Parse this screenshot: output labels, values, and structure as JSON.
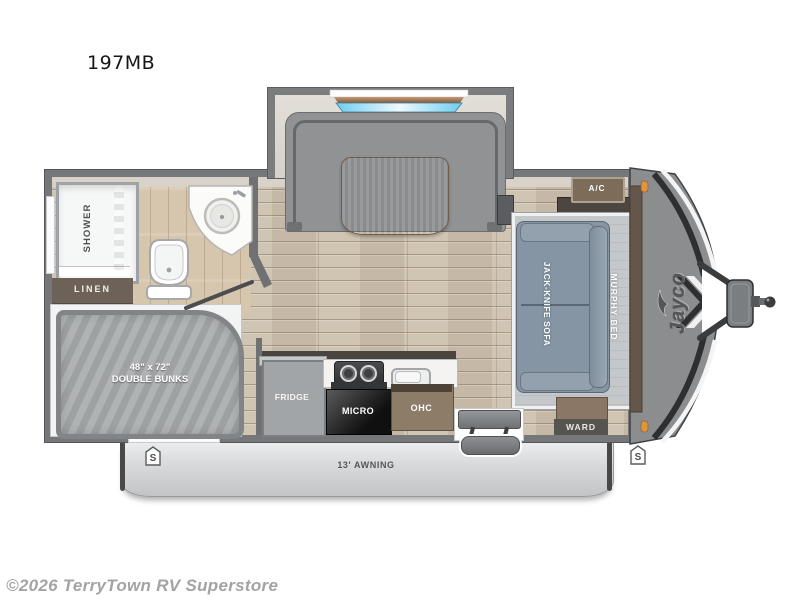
{
  "page": {
    "model_title": "197MB",
    "watermark": "©2026 TerryTown RV Superstore"
  },
  "floorplan": {
    "bathroom": {
      "shower": "SHOWER",
      "linen": "LINEN"
    },
    "bunkroom": {
      "bunks_size": "48\" x 72\"",
      "bunks": "DOUBLE BUNKS"
    },
    "kitchen": {
      "fridge": "FRIDGE",
      "micro": "MICRO",
      "ohc": "OHC"
    },
    "living": {
      "sofa": "JACK-KNIFE SOFA",
      "murphy_bed": "MURPHY BED",
      "ac": "A/C",
      "wardrobe": "WARD"
    },
    "exterior": {
      "awning": "13' AWNING",
      "brand": "Jayco",
      "speaker_badge": "S"
    },
    "colors": {
      "wall_gray": "#75777a",
      "floor_wood": "#cdc0ae",
      "bath_tile": "#d6c6ae",
      "sofa_blue": "#8695a4",
      "mattress_gray": "#a7aaac",
      "marker_orange": "#e0943b",
      "window_glass": "#7fd2ee",
      "curtain_gold": "#d9a855"
    }
  }
}
